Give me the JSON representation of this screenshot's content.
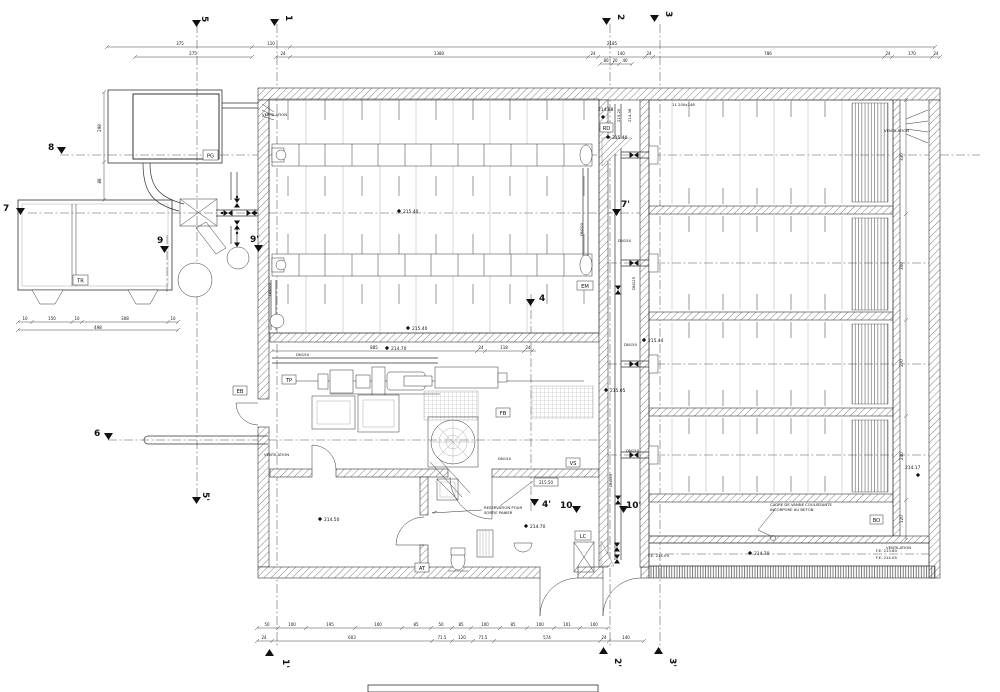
{
  "sections": {
    "s1": "1",
    "s1p": "1'",
    "s2": "2",
    "s2p": "2'",
    "s3": "3",
    "s3p": "3'",
    "s4": "4",
    "s4p": "4'",
    "s5": "5",
    "s5p": "5'",
    "s6": "6",
    "s7": "7",
    "s7p": "7'",
    "s8": "8",
    "s9": "9",
    "s9p": "9'",
    "s10": "10",
    "s10p": "10'"
  },
  "rooms": {
    "pg": "PG",
    "tr": "TR",
    "tp": "TP",
    "eb": "EB",
    "fb": "FB",
    "vs": "VS",
    "at": "AT",
    "lc": "LC",
    "em": "EM",
    "rd": "RD",
    "bo": "BO"
  },
  "elev": {
    "e21540": "215.40",
    "e21544": "215.44",
    "e21505": "215.05",
    "e21488": "214.88",
    "e21520": "215.20",
    "e21438": "214.38",
    "e21417": "214.17",
    "e21470": "214.70",
    "e21450": "214.50",
    "e21550": "215.50",
    "fe1": "F.E. 214.09",
    "fe2": "F.E. 213.60",
    "fe3": "F.E. 214.05"
  },
  "pipes": {
    "dn150": "DN150",
    "dn125": "DN125",
    "dn200": "DN200"
  },
  "notes": {
    "vent": "VENTILATION",
    "res1": "RESERVATION POUR",
    "res2": "SORTIE PANIER",
    "cad1": "CADRE DE VANNE COULISSANTE",
    "cad2": "INCORPORE AU BETON",
    "grid": "11 200x248"
  },
  "dims": {
    "top1": [
      "375",
      "110",
      "2185"
    ],
    "top2": [
      "275",
      "24",
      "1380",
      "24",
      "140",
      "24",
      "786",
      "24",
      "170",
      "24"
    ],
    "top3": [
      "80",
      "20",
      "40"
    ],
    "left": [
      "298",
      "88"
    ],
    "leftb": [
      "10",
      "150",
      "10",
      "308",
      "10"
    ],
    "leftb_total": "498",
    "right": [
      "330",
      "300",
      "270",
      "240",
      "120"
    ],
    "bsmall": [
      "50",
      "100",
      "195",
      "100",
      "85",
      "50",
      "85",
      "100",
      "85",
      "100",
      "101",
      "100"
    ],
    "bmain": [
      "24",
      "603",
      "71.5",
      "120",
      "71.5",
      "574",
      "24",
      "140"
    ],
    "mach": [
      "885",
      "24",
      "118",
      "24"
    ]
  }
}
